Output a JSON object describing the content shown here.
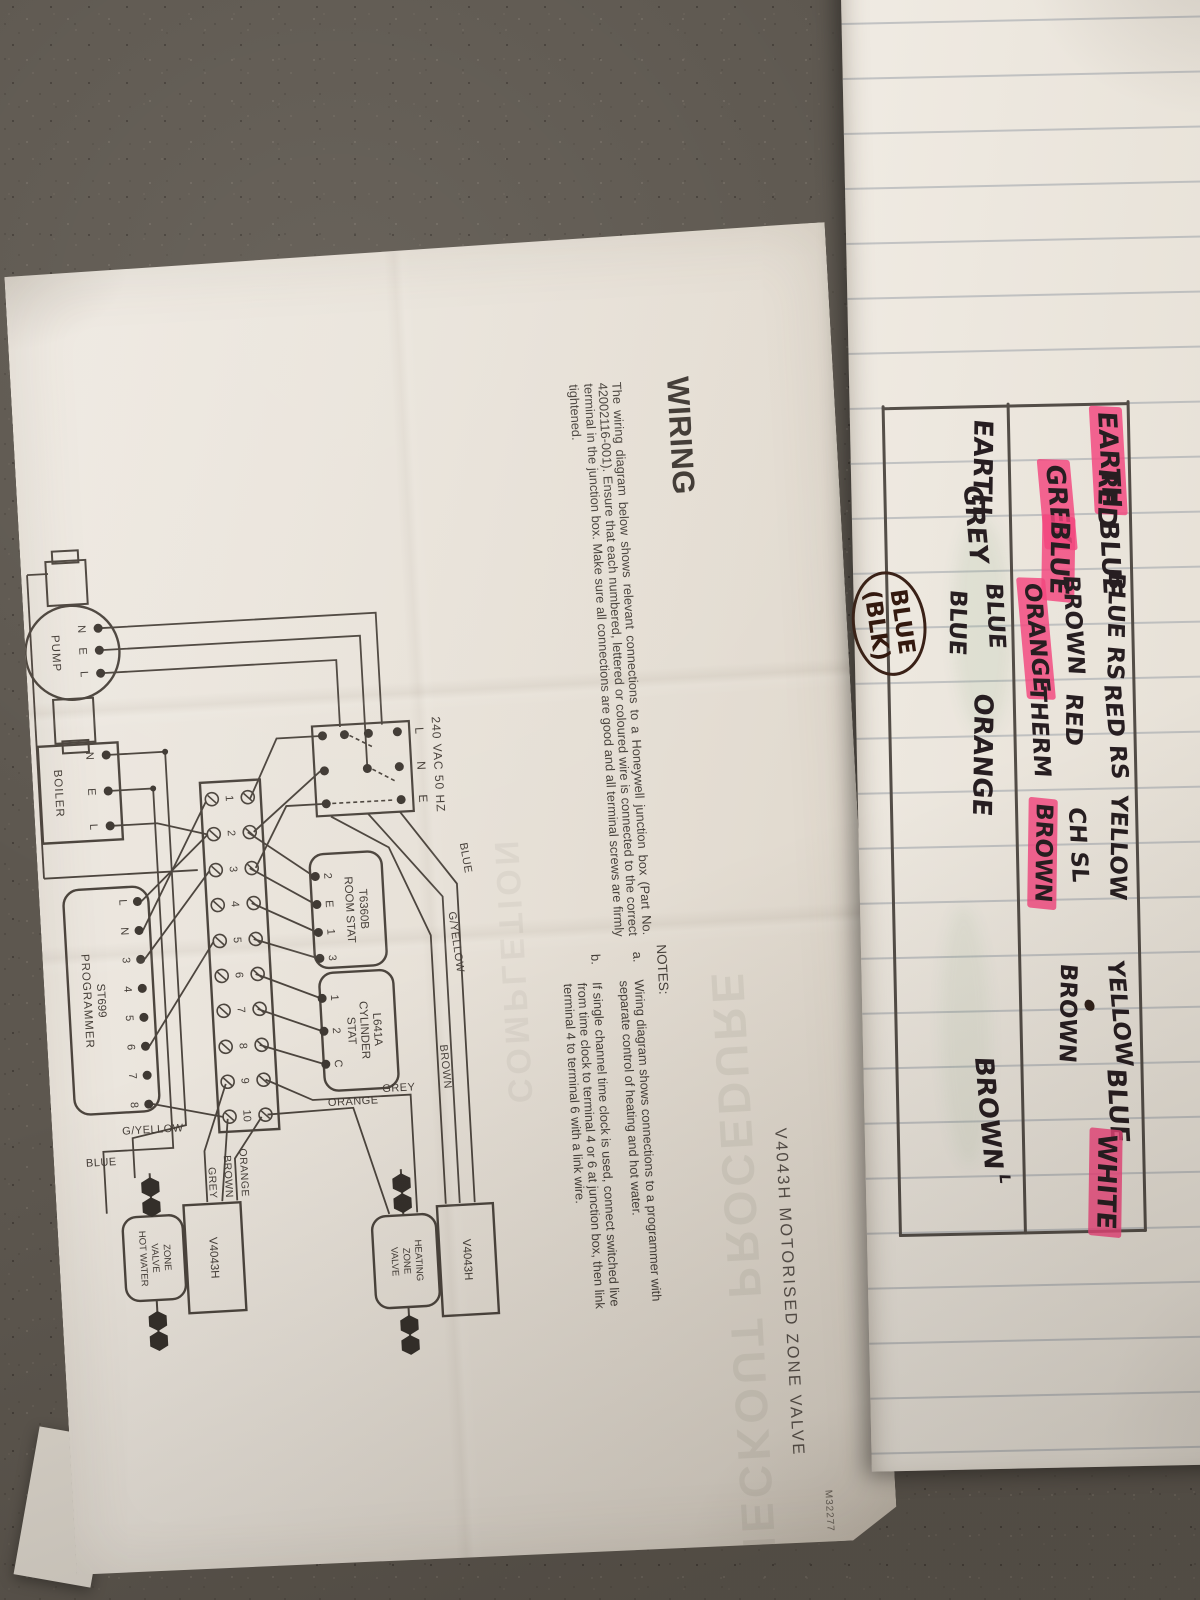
{
  "sheet": {
    "product_title": "V4043H MOTORISED ZONE VALVE",
    "doc_code": "M32277",
    "wiring_heading": "WIRING",
    "wiring_body": "The wiring diagram below shows relevant connections to a Honeywell junction box (Part No. 42002116-001). Ensure that each numbered, lettered or coloured wire is connected to the correct terminal in the junction box. Make sure all connections are good and all terminal screws are firmly tightened.",
    "notes_heading": "NOTES:",
    "note_a_label": "a.",
    "note_a": "Wiring diagram shows connections to a programmer with separate control of heating and hot water.",
    "note_b_label": "b.",
    "note_b": "If single channel time clock is used, connect switched live from time clock to terminal 4 or 6 at junction box, then link terminal 4 to terminal 6 with a link wire.",
    "showthrough_checkout": "CHECKOUT PROCEDURE",
    "showthrough_completion": "COMPLETION"
  },
  "diagram": {
    "mains_title": "240 VAC 50 HZ",
    "mains_terminals": [
      "L",
      "N",
      "E"
    ],
    "junction_terminals": [
      "1",
      "2",
      "3",
      "4",
      "5",
      "6",
      "7",
      "8",
      "9",
      "10"
    ],
    "programmer_line1": "ST699",
    "programmer_line2": "PROGRAMMER",
    "programmer_terminals": [
      "L",
      "N",
      "3",
      "4",
      "5",
      "6",
      "7",
      "8"
    ],
    "room_stat_line1": "T6360B",
    "room_stat_line2": "ROOM STAT",
    "room_stat_terminals": [
      "2",
      "E",
      "1",
      "3"
    ],
    "cyl_line1": "L641A",
    "cyl_line2": "CYLINDER",
    "cyl_line3": "STAT",
    "cyl_terminals": [
      "1",
      "2",
      "C"
    ],
    "pump_label": "PUMP",
    "pump_terminals": [
      "N",
      "E",
      "L"
    ],
    "boiler_label": "BOILER",
    "boiler_terminals": [
      "N",
      "E",
      "L"
    ],
    "hw_valve_model": "V4043H",
    "hw_valve_line1": "ZONE",
    "hw_valve_line2": "VALVE",
    "hw_valve_line3": "HOT WATER",
    "ch_valve_model": "V4043H",
    "ch_valve_line1": "HEATING",
    "ch_valve_line2": "ZONE",
    "ch_valve_line3": "VALVE",
    "wire_labels": {
      "blue": "BLUE",
      "gyellow": "G/YELLOW",
      "brown": "BROWN",
      "grey": "GREY",
      "orange": "ORANGE",
      "orange2": "ORANGE",
      "brown2": "BROWN",
      "grey2": "GREY",
      "gyellow2": "G/YELLOW",
      "blue2": "BLUE"
    }
  },
  "notebook": {
    "r1c1": "EARTH",
    "r1c2a": "RED",
    "r1c2b": "GREY",
    "r1c3a": "BLUE",
    "r1c3b": "BLUE",
    "r1c4a": "BLUE RS",
    "r1c4b": "BROWN",
    "r1c4c": "ORANGE",
    "r1c5a": "RED RS",
    "r1c5b": "RED",
    "r1c5c": "THERM",
    "r1c6a": "YELLOW",
    "r1c6b": "CH SL",
    "r1c6c": "BROWN",
    "r1c7a": "YELLOW",
    "r1c7b": "BROWN",
    "r1c8": "BLUE",
    "r1c9": "WHITE",
    "r2c1": "EARTH",
    "r2c2": "GREY",
    "r2c3a": "BLUE",
    "r2c3b": "BLUE",
    "r2c4": "ORANGE",
    "r2c5": "BROWN",
    "r2c5sup": "L",
    "note_line1": "BLUE",
    "note_line2": "(BLK)"
  }
}
